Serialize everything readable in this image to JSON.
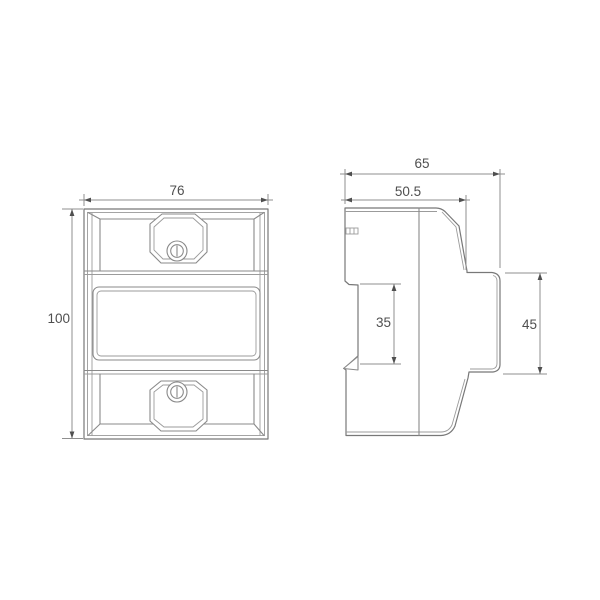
{
  "title": "Dimensional technical drawing of a DIN-rail meter enclosure (front view and side view)",
  "colors": {
    "background": "#ffffff",
    "line": "#8a8a8a",
    "dimension_text": "#4f4f4f"
  },
  "views": {
    "front": {
      "name": "front-view",
      "features": [
        "top-terminal-cover",
        "screw",
        "display-window",
        "bottom-terminal-cover",
        "screw"
      ]
    },
    "side": {
      "name": "side-view",
      "features": [
        "vent-slots",
        "din-rail-recess",
        "din-rail-clip-tooth",
        "rear-mounting-face"
      ]
    }
  },
  "labels": {
    "front_width": "76",
    "front_height": "100",
    "side_depth": "65",
    "side_front_depth": "50.5",
    "side_recess_height": "35",
    "side_rear_height": "45"
  }
}
